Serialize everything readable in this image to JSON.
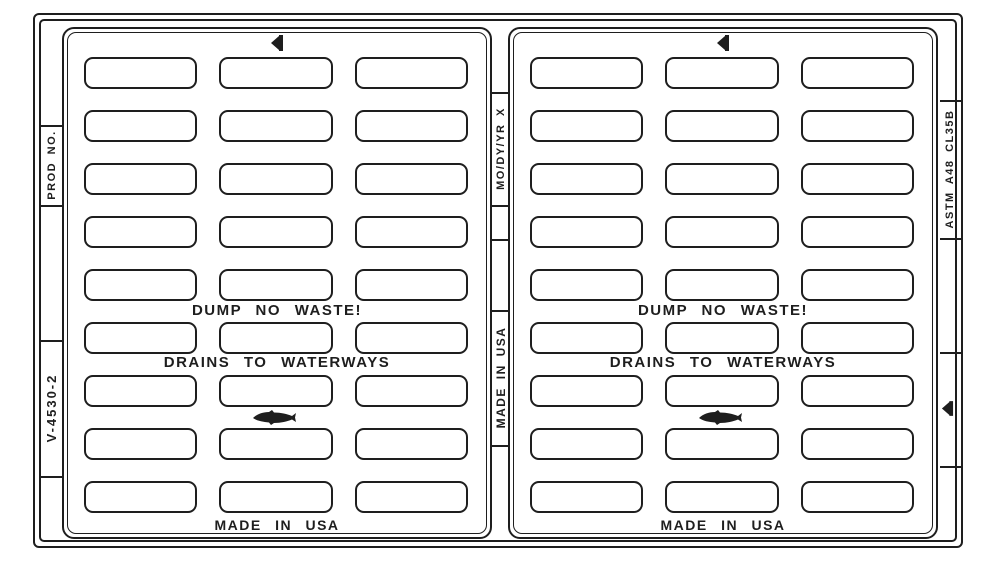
{
  "drawing": {
    "title": "cast grate pattern drawing",
    "grid": {
      "rows": 9,
      "columns": 3
    },
    "colors": {
      "line": "#1e1e1e",
      "background": "#ffffff"
    },
    "panels": [
      {
        "dump": "DUMP NO WASTE!",
        "drains": "DRAINS TO WATERWAYS",
        "made": "MADE IN USA"
      },
      {
        "dump": "DUMP NO WASTE!",
        "drains": "DRAINS TO WATERWAYS",
        "made": "MADE IN USA"
      }
    ],
    "rails": {
      "left_top": "PROD NO.",
      "left_bottom": "V-4530-2",
      "center_top": "MO/DY/YR X",
      "center_bottom": "MADE IN USA",
      "right_top": "ASTM A48 CL35B"
    },
    "icons": {
      "marker": "foundry-marker-icon",
      "fish": "fish-icon"
    }
  }
}
